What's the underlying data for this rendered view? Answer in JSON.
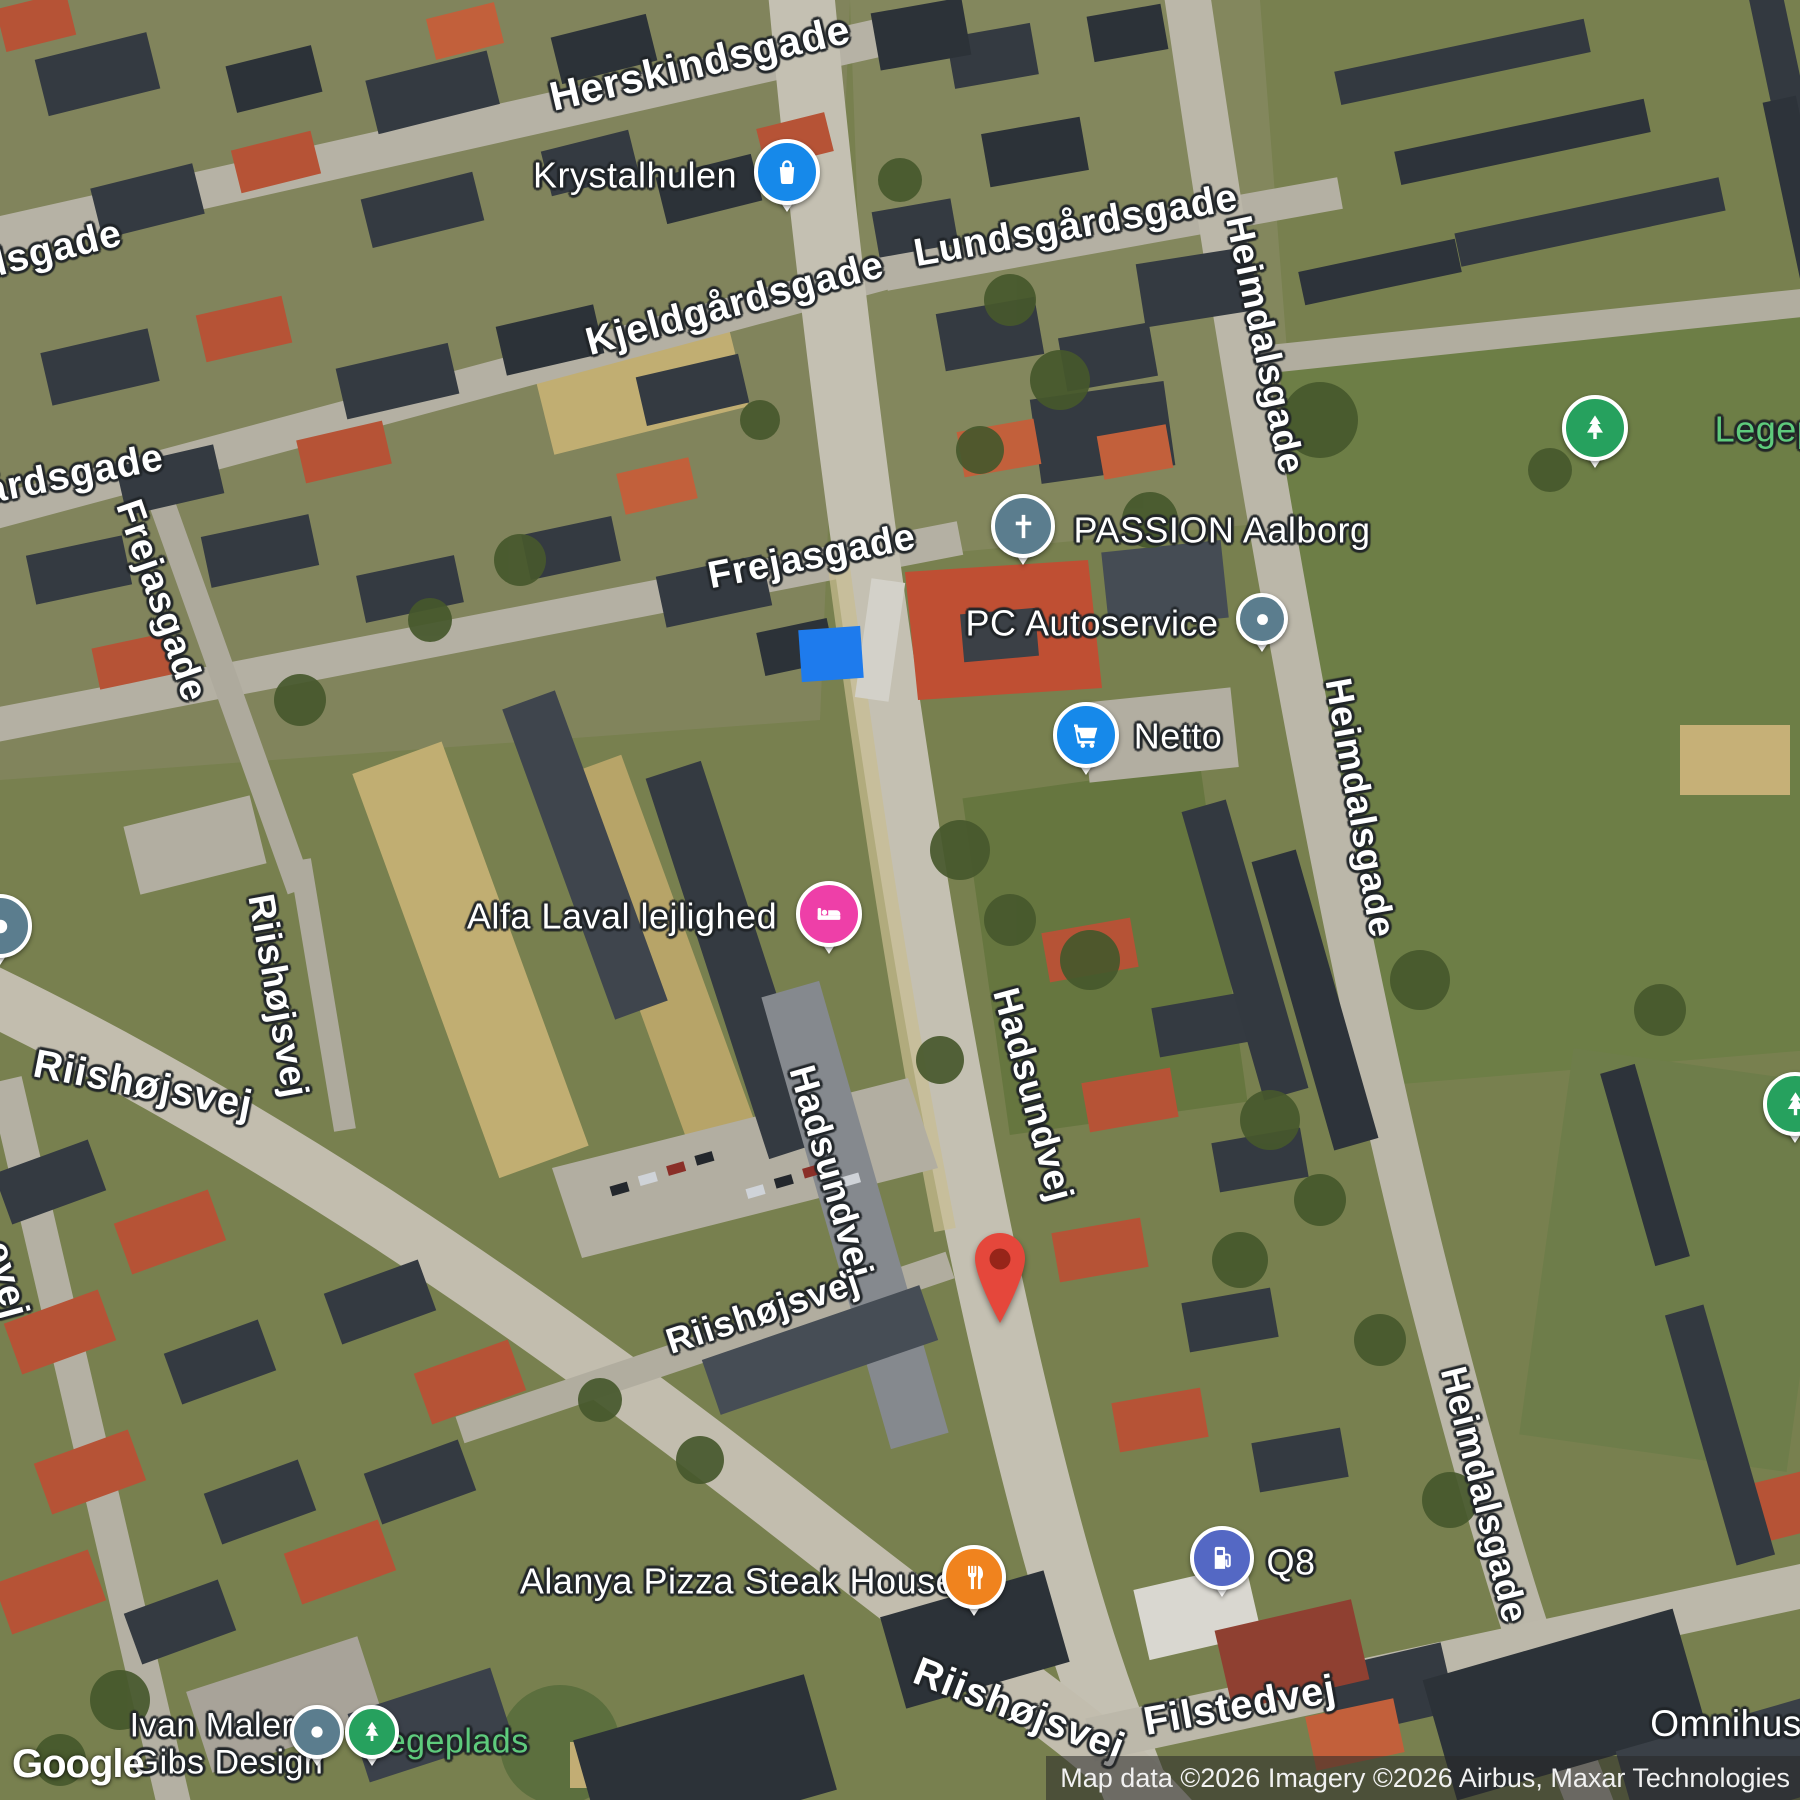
{
  "map": {
    "google_logo": "Google",
    "attribution": {
      "text": "Map data ©2026 Imagery ©2026 Airbus, Maxar Technologies"
    },
    "pin_colors": {
      "blue": "#1689ea",
      "slate": "#5b7d8e",
      "green": "#26a15e",
      "pink": "#ee3fa8",
      "orange": "#f0831e",
      "indigo": "#5468c4",
      "destination_body": "#e5473b",
      "destination_inner": "#972519"
    },
    "park_label_color": "#5ecb7c",
    "road_labels": [
      {
        "text": "Herskindsgade",
        "x": 700,
        "y": 63,
        "rot": -13,
        "size": 41
      },
      {
        "text": "Lundsgårdsgade",
        "x": 1076,
        "y": 226,
        "rot": -10,
        "size": 39
      },
      {
        "text": "Kjeldgårdsgade",
        "x": 735,
        "y": 304,
        "rot": -15,
        "size": 39
      },
      {
        "text": "Heimdalsgade",
        "x": 1265,
        "y": 345,
        "rot": 78,
        "size": 37
      },
      {
        "text": "dsgade",
        "x": 52,
        "y": 250,
        "rot": -14,
        "size": 39
      },
      {
        "text": "gårdsgade",
        "x": 62,
        "y": 477,
        "rot": -11,
        "size": 39
      },
      {
        "text": "Frejasgade",
        "x": 161,
        "y": 601,
        "rot": 71,
        "size": 38
      },
      {
        "text": "Frejasgade",
        "x": 812,
        "y": 557,
        "rot": -11,
        "size": 38
      },
      {
        "text": "Riishøjsvej",
        "x": 143,
        "y": 1085,
        "rot": 11,
        "size": 40
      },
      {
        "text": "Riishøjsvej",
        "x": 278,
        "y": 996,
        "rot": 80,
        "size": 37
      },
      {
        "text": "Hadsundvej",
        "x": 1033,
        "y": 1095,
        "rot": 75,
        "size": 37
      },
      {
        "text": "Hadsundvej",
        "x": 831,
        "y": 1172,
        "rot": 74,
        "size": 37
      },
      {
        "text": "Riishøjsvej",
        "x": 763,
        "y": 1312,
        "rot": -18,
        "size": 36
      },
      {
        "text": "Heimdalsgade",
        "x": 1360,
        "y": 808,
        "rot": 80,
        "size": 37
      },
      {
        "text": "Heimdalsgade",
        "x": 1484,
        "y": 1495,
        "rot": 76,
        "size": 37
      },
      {
        "text": "Riishøjsvej",
        "x": 1019,
        "y": 1710,
        "rot": 21,
        "size": 40
      },
      {
        "text": "Filstedvej",
        "x": 1240,
        "y": 1706,
        "rot": -10,
        "size": 40
      },
      {
        "text": "evej",
        "x": 6,
        "y": 1280,
        "rot": 75,
        "size": 38
      }
    ],
    "poi_labels": [
      {
        "text": "Krystalhulen",
        "x": 635,
        "y": 176,
        "size": 36
      },
      {
        "text": "PASSION Aalborg",
        "x": 1222,
        "y": 531,
        "size": 36
      },
      {
        "text": "PC Autoservice",
        "x": 1092,
        "y": 624,
        "size": 36
      },
      {
        "text": "Netto",
        "x": 1178,
        "y": 737,
        "size": 36
      },
      {
        "text": "Legeplads",
        "x": 1800,
        "y": 430,
        "size": 36,
        "kind": "park"
      },
      {
        "text": "Alfa Laval lejlighed",
        "x": 622,
        "y": 917,
        "size": 36
      },
      {
        "text": "Alanya Pizza Steak House",
        "x": 738,
        "y": 1582,
        "size": 36
      },
      {
        "text": "Q8",
        "x": 1291,
        "y": 1563,
        "size": 36
      },
      {
        "text": "Ivan Maler &\nGibs Design",
        "x": 228,
        "y": 1744,
        "size": 34
      },
      {
        "text": "Legeplads",
        "x": 448,
        "y": 1742,
        "size": 34,
        "kind": "park"
      },
      {
        "text": "Omnihus",
        "x": 1726,
        "y": 1724,
        "size": 37
      }
    ],
    "markers": [
      {
        "name": "krystalhulen",
        "icon": "shopping-bag",
        "color": "blue",
        "x": 787,
        "y": 172,
        "d": 58
      },
      {
        "name": "passion-aalborg",
        "icon": "cross",
        "color": "slate",
        "x": 1023,
        "y": 526,
        "d": 56
      },
      {
        "name": "pc-autoservice",
        "icon": "dot",
        "color": "slate",
        "x": 1262,
        "y": 619,
        "d": 44
      },
      {
        "name": "netto",
        "icon": "cart",
        "color": "blue",
        "x": 1086,
        "y": 735,
        "d": 58
      },
      {
        "name": "legeplads-north",
        "icon": "tree",
        "color": "green",
        "x": 1595,
        "y": 428,
        "d": 58
      },
      {
        "name": "alfa-laval",
        "icon": "bed",
        "color": "pink",
        "x": 829,
        "y": 914,
        "d": 58
      },
      {
        "name": "alanya-pizza",
        "icon": "restaurant",
        "color": "orange",
        "x": 974,
        "y": 1577,
        "d": 56
      },
      {
        "name": "q8",
        "icon": "gas",
        "color": "indigo",
        "x": 1222,
        "y": 1558,
        "d": 56
      },
      {
        "name": "ivan-maler",
        "icon": "dot",
        "color": "slate",
        "x": 317,
        "y": 1732,
        "d": 46
      },
      {
        "name": "legeplads-south",
        "icon": "tree",
        "color": "green",
        "x": 372,
        "y": 1732,
        "d": 46
      },
      {
        "name": "edge-west",
        "icon": "dot",
        "color": "slate",
        "x": 0,
        "y": 926,
        "d": 56
      },
      {
        "name": "edge-east",
        "icon": "tree",
        "color": "green",
        "x": 1795,
        "y": 1104,
        "d": 56
      }
    ],
    "destination_marker": {
      "x": 1000,
      "y": 1327
    }
  }
}
